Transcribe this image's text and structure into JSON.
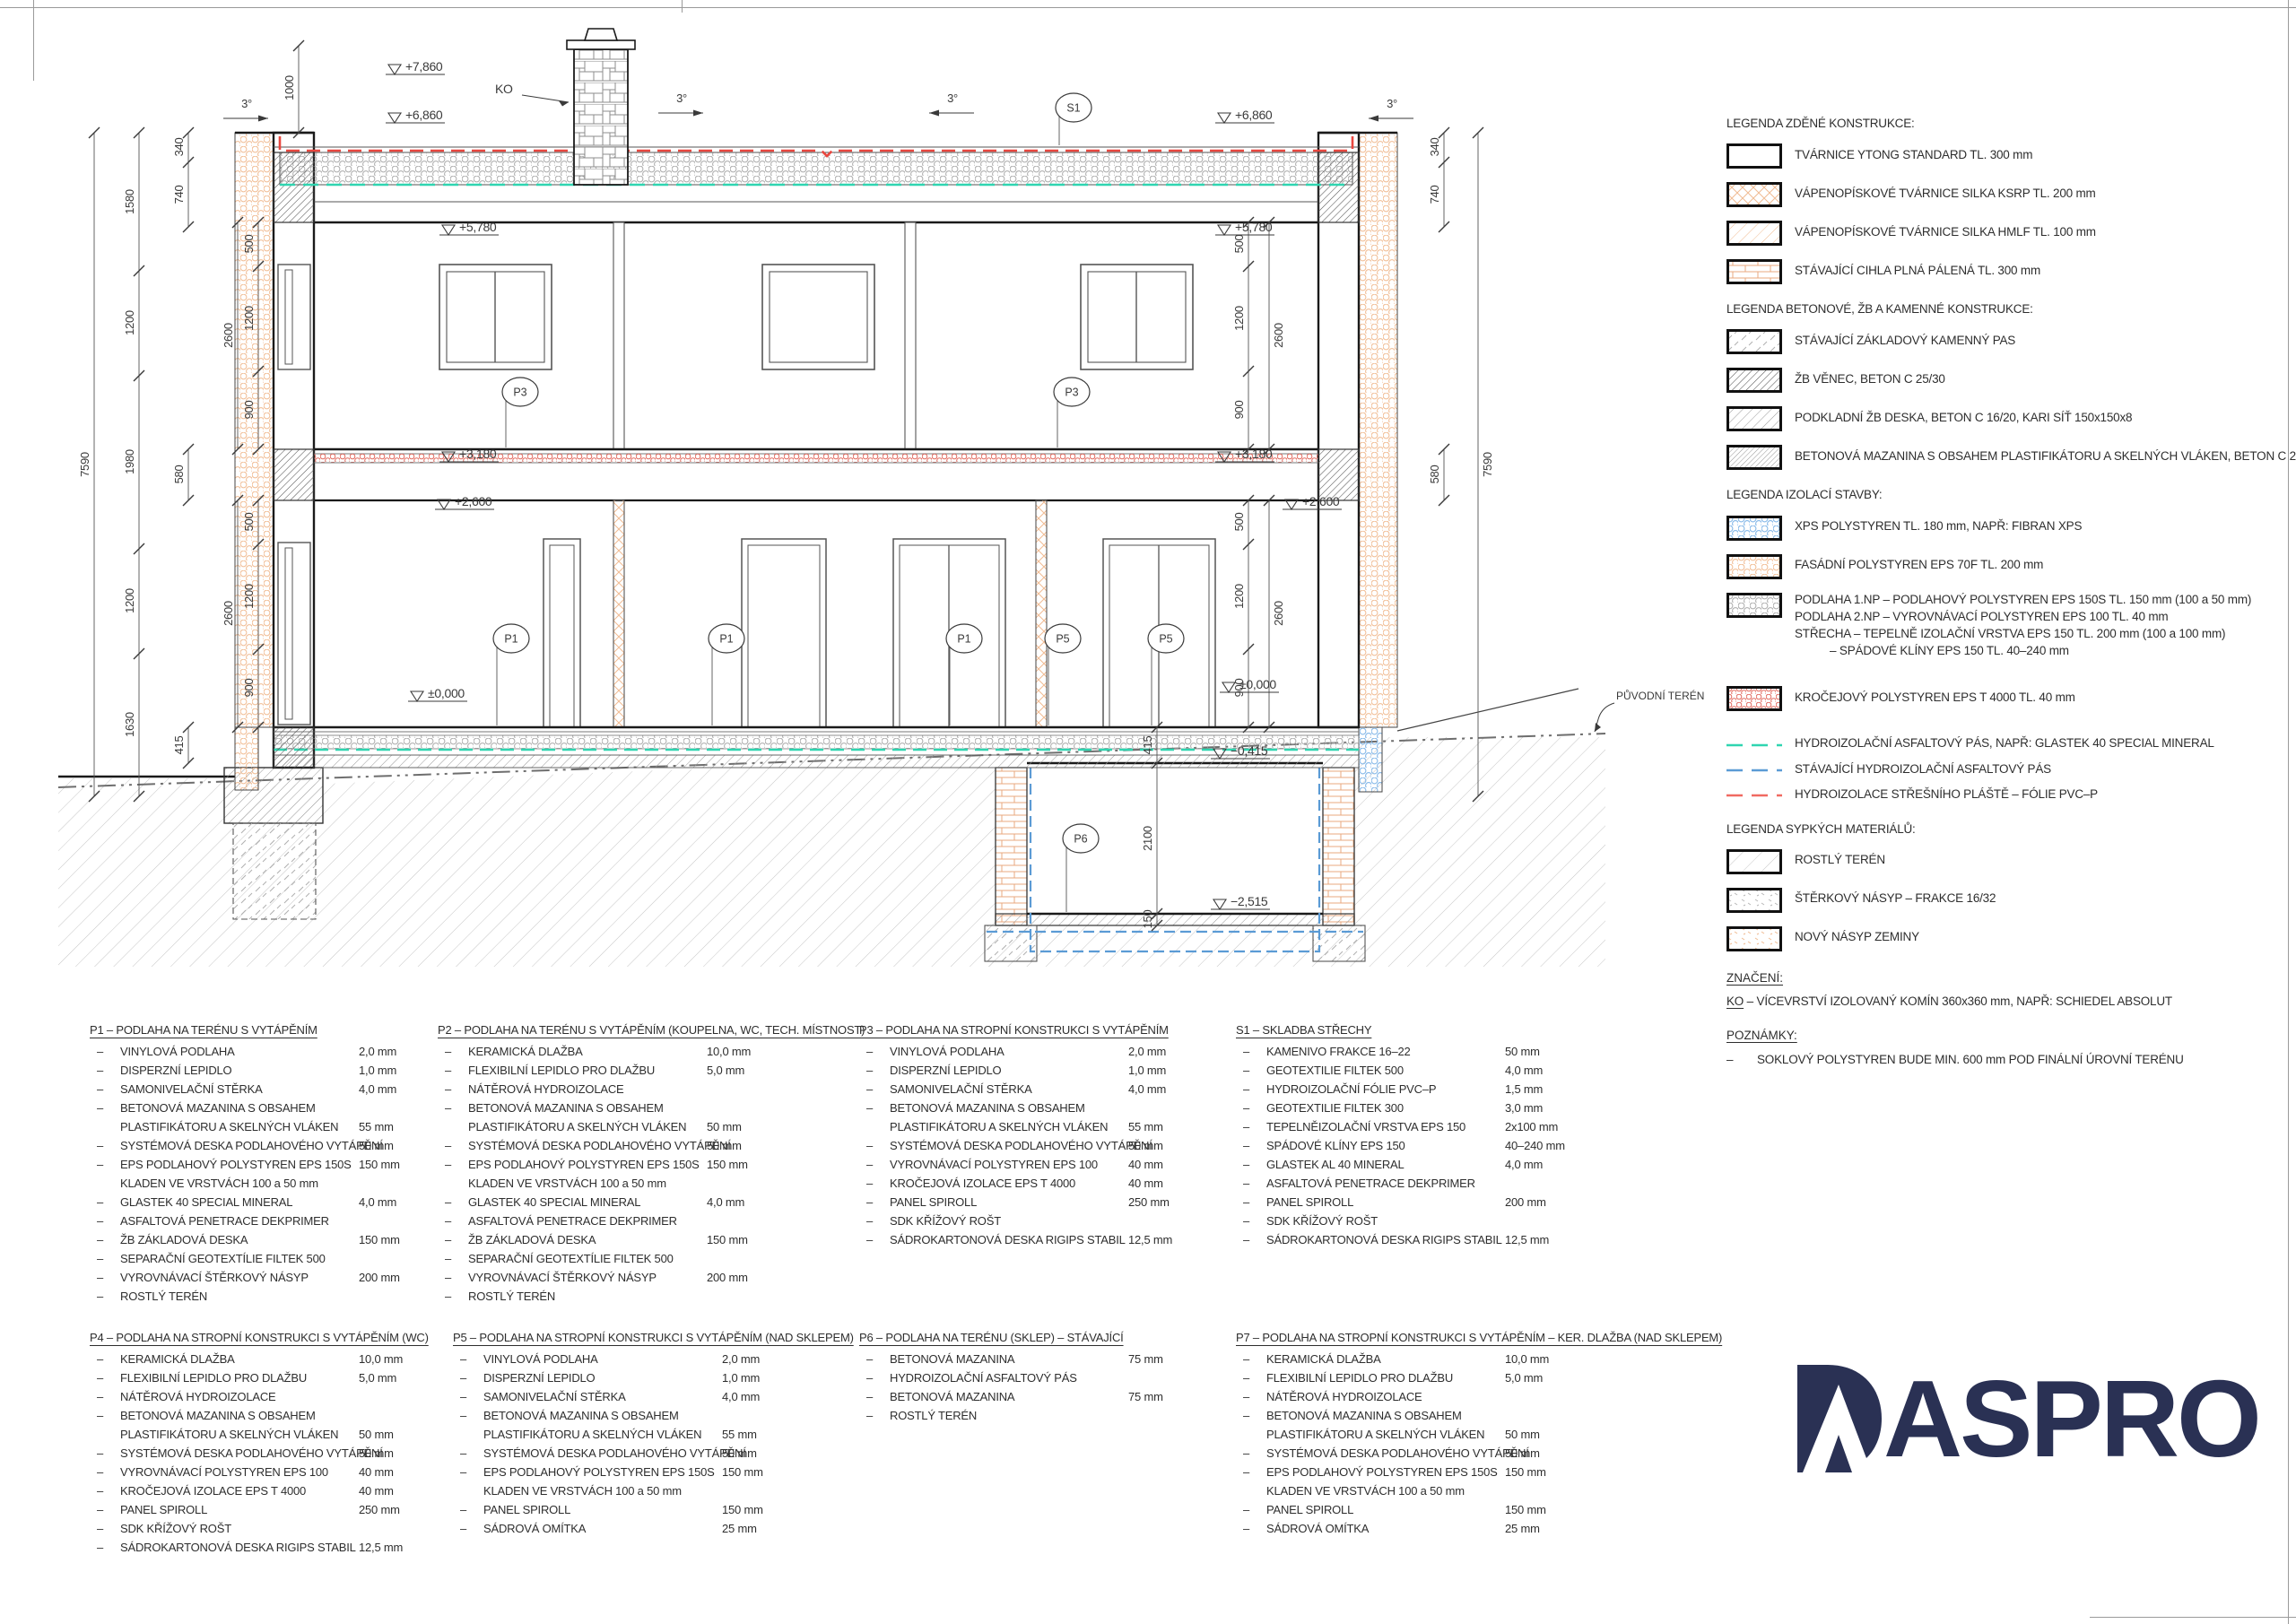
{
  "drawing": {
    "lv": {
      "p7860": "+7,860",
      "p6860": "+6,860",
      "p5780": "+5,780",
      "p3180": "+3,180",
      "p2600": "+2,600",
      "z0": "±0,000",
      "m0415": "−0,415",
      "m2515": "−2,515"
    },
    "dim": {
      "d7590": "7590",
      "d1580": "1580",
      "d1200": "1200",
      "d1980": "1980",
      "d1630": "1630",
      "d1000": "1000",
      "d340": "340",
      "d740": "740",
      "d500": "500",
      "d900": "900",
      "d2600": "2600",
      "d580": "580",
      "d415": "415",
      "d2100": "2100",
      "d150": "150"
    },
    "mk": {
      "s1": "S1",
      "p1": "P1",
      "p3": "P3",
      "p5": "P5",
      "p6": "P6",
      "ko": "KO"
    },
    "slope": "3°",
    "terrain_label": "PŮVODNÍ TERÉN"
  },
  "legend": {
    "sections": [
      {
        "title": "LEGENDA ZDĚNÉ KONSTRUKCE:",
        "items": [
          {
            "sw": "ytong",
            "lines": [
              "TVÁRNICE YTONG STANDARD TL. 300 mm"
            ]
          },
          {
            "sw": "ksrp",
            "lines": [
              "VÁPENOPÍSKOVÉ TVÁRNICE SILKA KSRP TL. 200 mm"
            ]
          },
          {
            "sw": "hmlf",
            "lines": [
              "VÁPENOPÍSKOVÉ TVÁRNICE SILKA HMLF TL. 100 mm"
            ]
          },
          {
            "sw": "cihla",
            "lines": [
              "STÁVAJÍCÍ CIHLA PLNÁ PÁLENÁ TL. 300 mm"
            ]
          }
        ]
      },
      {
        "title": "LEGENDA BETONOVÉ, ŽB A KAMENNÉ KONSTRUKCE:",
        "items": [
          {
            "sw": "kamen",
            "lines": [
              "STÁVAJÍCÍ ZÁKLADOVÝ KAMENNÝ PAS"
            ]
          },
          {
            "sw": "venec",
            "lines": [
              "ŽB VĚNEC, BETON C 25/30"
            ]
          },
          {
            "sw": "podkladni",
            "lines": [
              "PODKLADNÍ ŽB DESKA, BETON C 16/20, KARI SÍŤ 150x150x8"
            ]
          },
          {
            "sw": "mazanina",
            "lines": [
              "BETONOVÁ MAZANINA S OBSAHEM PLASTIFIKÁTORU A SKELNÝCH VLÁKEN, BETON C 20/25"
            ]
          }
        ]
      },
      {
        "title": "LEGENDA IZOLACÍ STAVBY:",
        "items": [
          {
            "sw": "xps",
            "lines": [
              "XPS POLYSTYREN TL. 180 mm, NAPŘ: FIBRAN XPS"
            ]
          },
          {
            "sw": "eps70",
            "lines": [
              "FASÁDNÍ POLYSTYREN EPS 70F TL. 200 mm"
            ]
          },
          {
            "sw": "epsfloor",
            "lines": [
              "PODLAHA 1.NP – PODLAHOVÝ POLYSTYREN EPS 150S TL. 150 mm (100 a 50 mm)",
              "PODLAHA 2.NP – VYROVNÁVACÍ POLYSTYREN EPS 100 TL. 40 mm",
              "STŘECHA – TEPELNĚ IZOLAČNÍ VRSTVA EPS 150 TL. 200 mm (100 a 100 mm)",
              "           – SPÁDOVÉ KLÍNY EPS 150 TL. 40–240 mm"
            ]
          },
          {
            "sw": "krocej",
            "gap": true,
            "lines": [
              "KROČEJOVÝ POLYSTYREN EPS T 4000 TL. 40 mm"
            ]
          },
          {
            "sw": "line-teal",
            "gap": true,
            "line": true,
            "lines": [
              "HYDROIZOLAČNÍ ASFALTOVÝ PÁS, NAPŘ: GLASTEK 40 SPECIAL MINERAL"
            ]
          },
          {
            "sw": "line-blue",
            "line": true,
            "lines": [
              "STÁVAJÍCÍ HYDROIZOLAČNÍ ASFALTOVÝ PÁS"
            ]
          },
          {
            "sw": "line-red",
            "line": true,
            "lines": [
              "HYDROIZOLACE STŘEŠNÍHO PLÁŠTĚ – FÓLIE PVC–P"
            ]
          }
        ]
      },
      {
        "title": "LEGENDA SYPKÝCH MATERIÁLŮ:",
        "items": [
          {
            "sw": "rostly",
            "lines": [
              "ROSTLÝ TERÉN"
            ]
          },
          {
            "sw": "sterk",
            "lines": [
              "ŠTĚRKOVÝ NÁSYP – FRAKCE 16/32"
            ]
          },
          {
            "sw": "nasyp",
            "lines": [
              "NOVÝ NÁSYP ZEMINY"
            ]
          }
        ]
      }
    ],
    "znaceni_title": "ZNAČENÍ:",
    "ko_label": "KO",
    "ko_text": " – VÍCEVRSTVÍ IZOLOVANÝ KOMÍN 360x360 mm, NAPŘ: SCHIEDEL ABSOLUT",
    "poznamky_title": "POZNÁMKY:",
    "note_dash": "–",
    "note_text": "SOKLOVÝ POLYSTYREN BUDE MIN. 600 mm POD FINÁLNÍ ÚROVNÍ TERÉNU"
  },
  "specs": [
    {
      "id": "P1",
      "title": "P1 – PODLAHA NA TERÉNU S VYTÁPĚNÍM",
      "rows": [
        [
          "–",
          "VINYLOVÁ PODLAHA",
          "2,0 mm"
        ],
        [
          "–",
          "DISPERZNÍ LEPIDLO",
          "1,0 mm"
        ],
        [
          "–",
          "SAMONIVELAČNÍ STĚRKA",
          "4,0 mm"
        ],
        [
          "–",
          "BETONOVÁ MAZANINA S OBSAHEM",
          ""
        ],
        [
          "",
          "PLASTIFIKÁTORU A SKELNÝCH VLÁKEN",
          "55 mm"
        ],
        [
          "–",
          "SYSTÉMOVÁ DESKA PODLAHOVÉHO VYTÁPĚNÍ",
          "50 mm"
        ],
        [
          "–",
          "EPS PODLAHOVÝ POLYSTYREN EPS 150S",
          "150 mm"
        ],
        [
          "",
          "KLADEN VE VRSTVÁCH 100 a 50 mm",
          ""
        ],
        [
          "–",
          "GLASTEK 40 SPECIAL MINERAL",
          "4,0 mm"
        ],
        [
          "–",
          "ASFALTOVÁ PENETRACE DEKPRIMER",
          ""
        ],
        [
          "–",
          "ŽB ZÁKLADOVÁ DESKA",
          "150 mm"
        ],
        [
          "–",
          "SEPARAČNÍ GEOTEXTÍLIE FILTEK 500",
          ""
        ],
        [
          "–",
          "VYROVNÁVACÍ ŠTĚRKOVÝ NÁSYP",
          "200 mm"
        ],
        [
          "–",
          "ROSTLÝ TERÉN",
          ""
        ]
      ]
    },
    {
      "id": "P2",
      "title": "P2 – PODLAHA NA TERÉNU S VYTÁPĚNÍM (KOUPELNA, WC, TECH. MÍSTNOST)",
      "rows": [
        [
          "–",
          "KERAMICKÁ DLAŽBA",
          "10,0 mm"
        ],
        [
          "–",
          "FLEXIBILNÍ LEPIDLO PRO DLAŽBU",
          "5,0 mm"
        ],
        [
          "–",
          "NÁTĚROVÁ HYDROIZOLACE",
          ""
        ],
        [
          "–",
          "BETONOVÁ MAZANINA S OBSAHEM",
          ""
        ],
        [
          "",
          "PLASTIFIKÁTORU A SKELNÝCH VLÁKEN",
          "50 mm"
        ],
        [
          "–",
          "SYSTÉMOVÁ DESKA PODLAHOVÉHO VYTÁPĚNÍ",
          "50 mm"
        ],
        [
          "–",
          "EPS PODLAHOVÝ POLYSTYREN EPS 150S",
          "150 mm"
        ],
        [
          "",
          "KLADEN VE VRSTVÁCH 100 a 50 mm",
          ""
        ],
        [
          "–",
          "GLASTEK 40 SPECIAL MINERAL",
          "4,0 mm"
        ],
        [
          "–",
          "ASFALTOVÁ PENETRACE DEKPRIMER",
          ""
        ],
        [
          "–",
          "ŽB ZÁKLADOVÁ DESKA",
          "150 mm"
        ],
        [
          "–",
          "SEPARAČNÍ GEOTEXTÍLIE FILTEK 500",
          ""
        ],
        [
          "–",
          "VYROVNÁVACÍ ŠTĚRKOVÝ NÁSYP",
          "200 mm"
        ],
        [
          "–",
          "ROSTLÝ TERÉN",
          ""
        ]
      ]
    },
    {
      "id": "P3",
      "title": "P3 – PODLAHA NA STROPNÍ KONSTRUKCI S VYTÁPĚNÍM",
      "rows": [
        [
          "–",
          "VINYLOVÁ PODLAHA",
          "2,0 mm"
        ],
        [
          "–",
          "DISPERZNÍ LEPIDLO",
          "1,0 mm"
        ],
        [
          "–",
          "SAMONIVELAČNÍ STĚRKA",
          "4,0 mm"
        ],
        [
          "–",
          "BETONOVÁ MAZANINA S OBSAHEM",
          ""
        ],
        [
          "",
          "PLASTIFIKÁTORU A SKELNÝCH VLÁKEN",
          "55 mm"
        ],
        [
          "–",
          "SYSTÉMOVÁ DESKA PODLAHOVÉHO VYTÁPĚNÍ",
          "50 mm"
        ],
        [
          "–",
          "VYROVNÁVACÍ POLYSTYREN EPS 100",
          "40 mm"
        ],
        [
          "–",
          "KROČEJOVÁ IZOLACE EPS T 4000",
          "40 mm"
        ],
        [
          "–",
          "PANEL SPIROLL",
          "250 mm"
        ],
        [
          "–",
          "SDK KŘÍŽOVÝ ROŠT",
          ""
        ],
        [
          "–",
          "SÁDROKARTONOVÁ DESKA RIGIPS STABIL",
          "12,5 mm"
        ]
      ]
    },
    {
      "id": "S1",
      "title": "S1 – SKLADBA STŘECHY",
      "rows": [
        [
          "–",
          "KAMENIVO FRAKCE 16–22",
          "50 mm"
        ],
        [
          "–",
          "GEOTEXTILIE FILTEK 500",
          "4,0 mm"
        ],
        [
          "–",
          "HYDROIZOLAČNÍ FÓLIE PVC–P",
          "1,5 mm"
        ],
        [
          "–",
          "GEOTEXTILIE FILTEK 300",
          "3,0 mm"
        ],
        [
          "–",
          "TEPELNĚIZOLAČNÍ VRSTVA EPS 150",
          "2x100 mm"
        ],
        [
          "–",
          "SPÁDOVÉ KLÍNY EPS 150",
          "40–240 mm"
        ],
        [
          "–",
          "GLASTEK AL 40 MINERAL",
          "4,0 mm"
        ],
        [
          "–",
          "ASFALTOVÁ PENETRACE DEKPRIMER",
          ""
        ],
        [
          "–",
          "PANEL SPIROLL",
          "200 mm"
        ],
        [
          "–",
          "SDK KŘÍŽOVÝ ROŠT",
          ""
        ],
        [
          "–",
          "SÁDROKARTONOVÁ DESKA RIGIPS STABIL",
          "12,5 mm"
        ]
      ]
    },
    {
      "id": "P4",
      "title": "P4 – PODLAHA NA STROPNÍ KONSTRUKCI S VYTÁPĚNÍM (WC)",
      "rows": [
        [
          "–",
          "KERAMICKÁ DLAŽBA",
          "10,0 mm"
        ],
        [
          "–",
          "FLEXIBILNÍ LEPIDLO PRO DLAŽBU",
          "5,0 mm"
        ],
        [
          "–",
          "NÁTĚROVÁ HYDROIZOLACE",
          ""
        ],
        [
          "–",
          "BETONOVÁ MAZANINA S OBSAHEM",
          ""
        ],
        [
          "",
          "PLASTIFIKÁTORU A SKELNÝCH VLÁKEN",
          "50 mm"
        ],
        [
          "–",
          "SYSTÉMOVÁ DESKA PODLAHOVÉHO VYTÁPĚNÍ",
          "50 mm"
        ],
        [
          "–",
          "VYROVNÁVACÍ POLYSTYREN EPS 100",
          "40 mm"
        ],
        [
          "–",
          "KROČEJOVÁ IZOLACE EPS T 4000",
          "40 mm"
        ],
        [
          "–",
          "PANEL SPIROLL",
          "250 mm"
        ],
        [
          "–",
          "SDK KŘÍŽOVÝ ROŠT",
          ""
        ],
        [
          "–",
          "SÁDROKARTONOVÁ DESKA RIGIPS STABIL",
          "12,5 mm"
        ]
      ]
    },
    {
      "id": "P5",
      "title": "P5 – PODLAHA NA STROPNÍ KONSTRUKCI S VYTÁPĚNÍM (NAD SKLEPEM)",
      "rows": [
        [
          "–",
          "VINYLOVÁ PODLAHA",
          "2,0 mm"
        ],
        [
          "–",
          "DISPERZNÍ LEPIDLO",
          "1,0 mm"
        ],
        [
          "–",
          "SAMONIVELAČNÍ STĚRKA",
          "4,0 mm"
        ],
        [
          "–",
          "BETONOVÁ MAZANINA S OBSAHEM",
          ""
        ],
        [
          "",
          "PLASTIFIKÁTORU A SKELNÝCH VLÁKEN",
          "55 mm"
        ],
        [
          "–",
          "SYSTÉMOVÁ DESKA PODLAHOVÉHO VYTÁPĚNÍ",
          "50 mm"
        ],
        [
          "–",
          "EPS PODLAHOVÝ POLYSTYREN EPS 150S",
          "150 mm"
        ],
        [
          "",
          "KLADEN VE VRSTVÁCH 100 a 50 mm",
          ""
        ],
        [
          "–",
          "PANEL SPIROLL",
          "150 mm"
        ],
        [
          "–",
          "SÁDROVÁ OMÍTKA",
          "25 mm"
        ]
      ]
    },
    {
      "id": "P6",
      "title": "P6 – PODLAHA NA TERÉNU (SKLEP) – STÁVAJÍCÍ",
      "rows": [
        [
          "–",
          "BETONOVÁ MAZANINA",
          "75 mm"
        ],
        [
          "–",
          "HYDROIZOLAČNÍ ASFALTOVÝ PÁS",
          ""
        ],
        [
          "–",
          "BETONOVÁ MAZANINA",
          "75 mm"
        ],
        [
          "–",
          "ROSTLÝ TERÉN",
          ""
        ]
      ]
    },
    {
      "id": "P7",
      "title": "P7 – PODLAHA NA STROPNÍ KONSTRUKCI S VYTÁPĚNÍM – KER. DLAŽBA (NAD SKLEPEM)",
      "rows": [
        [
          "–",
          "KERAMICKÁ DLAŽBA",
          "10,0 mm"
        ],
        [
          "–",
          "FLEXIBILNÍ LEPIDLO PRO DLAŽBU",
          "5,0 mm"
        ],
        [
          "–",
          "NÁTĚROVÁ HYDROIZOLACE",
          ""
        ],
        [
          "–",
          "BETONOVÁ MAZANINA S OBSAHEM",
          ""
        ],
        [
          "",
          "PLASTIFIKÁTORU A SKELNÝCH VLÁKEN",
          "50 mm"
        ],
        [
          "–",
          "SYSTÉMOVÁ DESKA PODLAHOVÉHO VYTÁPĚNÍ",
          "50 mm"
        ],
        [
          "–",
          "EPS PODLAHOVÝ POLYSTYREN EPS 150S",
          "150 mm"
        ],
        [
          "",
          "KLADEN VE VRSTVÁCH 100 a 50 mm",
          ""
        ],
        [
          "–",
          "PANEL SPIROLL",
          "150 mm"
        ],
        [
          "–",
          "SÁDROVÁ OMÍTKA",
          "25 mm"
        ]
      ]
    }
  ],
  "logo": {
    "text": "DASPRO",
    "text_rest": "ASPRO"
  },
  "colors": {
    "accent_red": "#e8473f",
    "accent_teal": "#2fd5b0",
    "accent_blue": "#5b9bd5",
    "hatch_orange": "#f0bb92",
    "logo_navy": "#2a3154"
  }
}
